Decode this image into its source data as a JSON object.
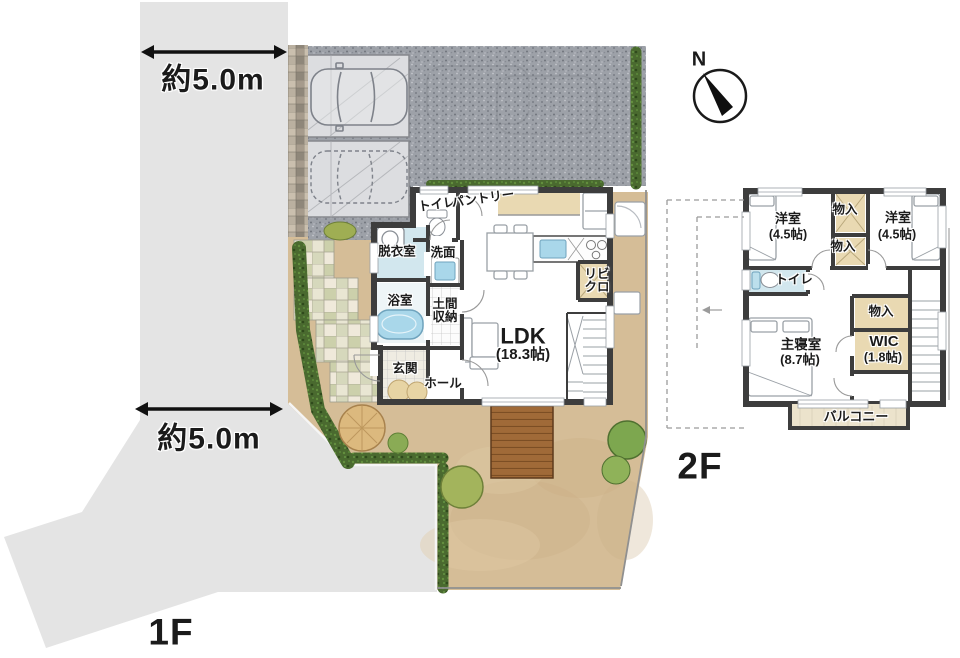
{
  "site": {
    "dim_top": "約5.0m",
    "dim_side": "約5.0m",
    "floor1_label": "1F",
    "floor2_label": "2F",
    "compass_n": "N"
  },
  "floor1": {
    "toilet": "トイレ",
    "pantry": "パントリー",
    "dressing_room": "脱衣室",
    "washroom": "洗面",
    "bathroom": "浴室",
    "doma_storage": "土間収納",
    "entrance": "玄関",
    "hall": "ホール",
    "ldk_name": "LDK",
    "ldk_size": "(18.3帖)",
    "living_closet": "リビクロ"
  },
  "floor2": {
    "west_room_name": "洋室",
    "west_room_size": "(4.5帖)",
    "closet_top": "物入",
    "closet_mid": "物入",
    "east_room_name": "洋室",
    "east_room_size": "(4.5帖)",
    "toilet": "トイレ",
    "master_name": "主寝室",
    "master_size": "(8.7帖)",
    "closet_east": "物入",
    "wic_name": "WIC",
    "wic_size": "(1.8帖)",
    "balcony": "バルコニー"
  },
  "colors": {
    "road": "#e4e4e4",
    "asphalt": "#9da1a8",
    "concrete": "#dcdde0",
    "wall": "#3d3d3d",
    "garden_soil": "#d5bd97",
    "deck_wood": "#a06a38",
    "hedge_green": "#4a6a2f",
    "tree_green": "#7da74f",
    "tree_tan": "#dcb97e",
    "water_blue": "#a9d7ea",
    "closet_beige": "#e9d9b2",
    "tile_blue": "#d2e7ee",
    "balcony_floor": "#ece3cc"
  }
}
